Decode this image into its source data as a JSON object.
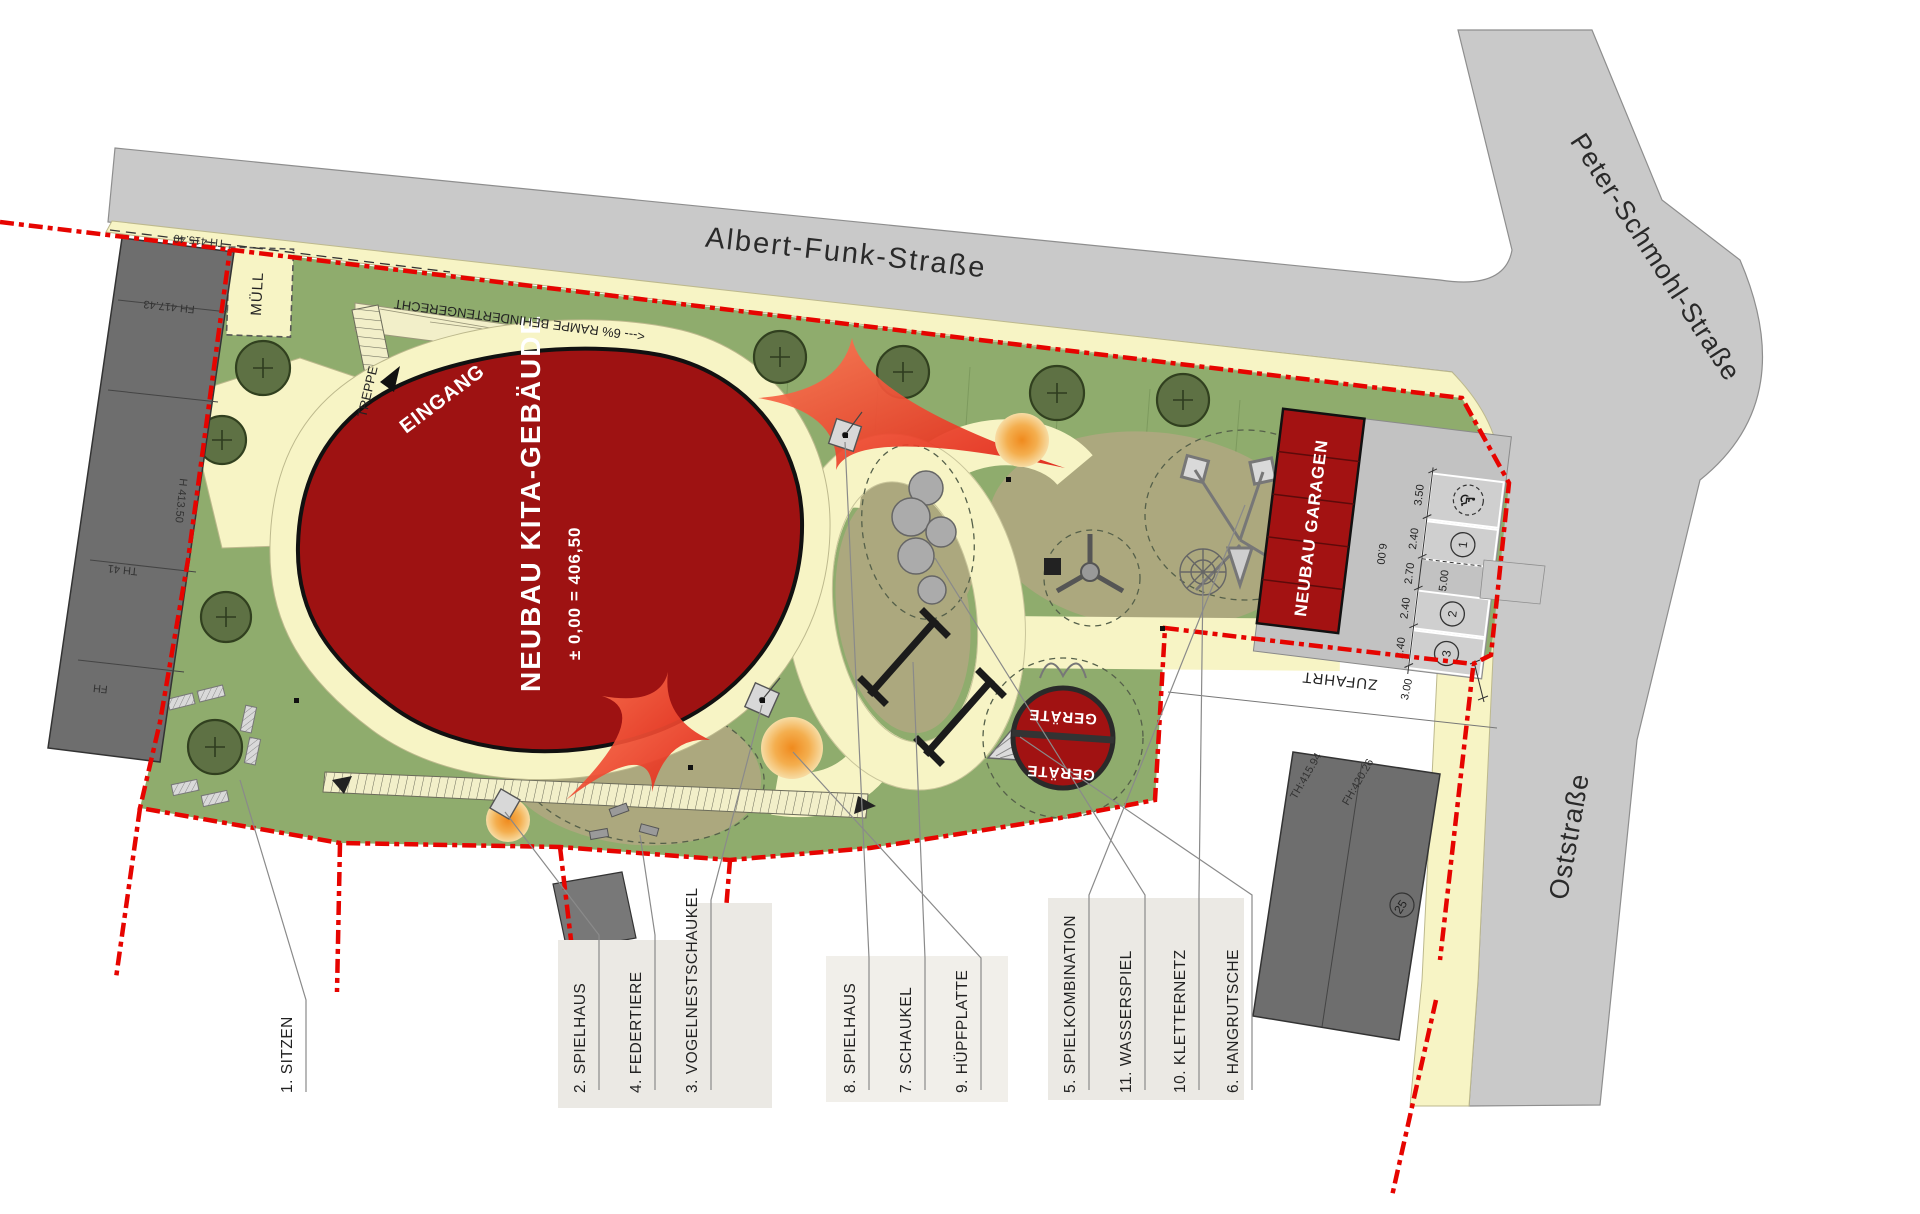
{
  "canvas": {
    "width": 1920,
    "height": 1214
  },
  "colors": {
    "street": "#C9C9C9",
    "sidewalk": "#F7F4C5",
    "lawn": "#8FAC6D",
    "play_surface": "#ACA87E",
    "kita_building": "#9E1212",
    "garage_building": "#A31212",
    "boundary_red": "#E60400",
    "existing_building": "#6E6E6E",
    "tree": "#5E7144",
    "orange_feature": "#F2992E",
    "sail_red": "#E8352A",
    "legend_panel": "#EBE9E4"
  },
  "streets": {
    "albert_funk": "Albert-Funk-Straße",
    "peter_schmohl": "Peter-Schmohl-Straße",
    "ost": "Oststraße"
  },
  "site": {
    "eingang": "EINGANG",
    "kita_name": "NEUBAU KITA-GEBÄUDE",
    "kita_level": "± 0,00 = 406,50",
    "garagen": "NEUBAU GARAGEN",
    "geraete_top": "GERÄTE",
    "geraete_bottom": "GERÄTE",
    "muell": "MÜLL",
    "treppe": "TREPPE",
    "rampe": "<--- 6%   RAMPE  BEHINDERTENGERECHT",
    "zufahrt": "ZUFAHRT",
    "wheelchair": "♿"
  },
  "dims": {
    "disabled": "3.50",
    "s1": "2.40",
    "aisle": "2.70",
    "d5": "5.00",
    "d6": "6.00",
    "s2": "2.40",
    "s3": "2.40",
    "drive": "3.00"
  },
  "parking": {
    "n1": "1",
    "n2": "2",
    "n3": "3"
  },
  "elev": {
    "left_top": "TH 415.40",
    "left_mid": "FH 417.43",
    "left_edge": "H 413.50",
    "left_low": "TH 41",
    "left_lower": "FH",
    "right_th": "TH:415.94",
    "right_fh": "FH:420.26",
    "right_no": "25"
  },
  "legend": {
    "items": [
      {
        "label": "1. SITZEN"
      },
      {
        "label": "2. SPIELHAUS"
      },
      {
        "label": "4. FEDERTIERE"
      },
      {
        "label": "3. VOGELNESTSCHAUKEL"
      },
      {
        "label": "8. SPIELHAUS"
      },
      {
        "label": "7. SCHAUKEL"
      },
      {
        "label": "9. HÜPFPLATTE"
      },
      {
        "label": "5. SPIELKOMBINATION"
      },
      {
        "label": "11. WASSERSPIEL"
      },
      {
        "label": "10. KLETTERNETZ"
      },
      {
        "label": "6. HANGRUTSCHE"
      }
    ]
  }
}
